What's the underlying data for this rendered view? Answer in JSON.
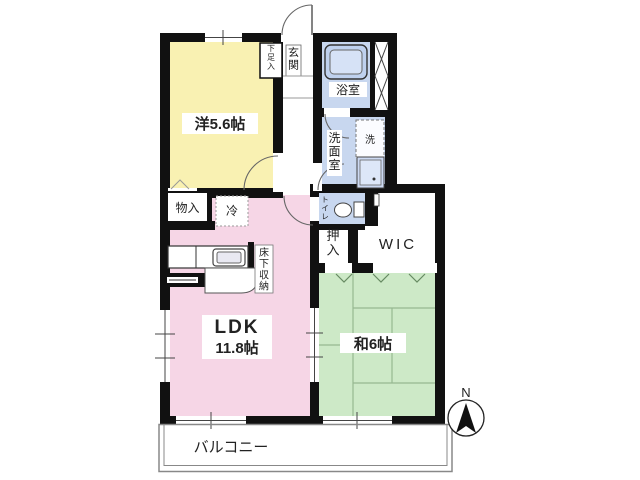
{
  "plan": {
    "type": "apartment-floor-plan",
    "rooms": {
      "western": {
        "label": "洋5.6帖"
      },
      "entrance": {
        "label": "玄関"
      },
      "shoe_cabinet": {
        "label": "下足入"
      },
      "bathroom": {
        "label": "浴室"
      },
      "washroom": {
        "label": "洗面室"
      },
      "washer": {
        "label": "洗"
      },
      "toilet": {
        "label": "トイレ"
      },
      "storage": {
        "label": "物入"
      },
      "fridge": {
        "label": "冷"
      },
      "underfloor_storage": {
        "label": "床下収納"
      },
      "ldk": {
        "label": "LDK",
        "size": "11.8帖"
      },
      "closet": {
        "label": "押入"
      },
      "wic": {
        "label": "WIC"
      },
      "japanese": {
        "label": "和6帖"
      },
      "balcony": {
        "label": "バルコニー"
      }
    },
    "compass": {
      "label": "N"
    },
    "colors": {
      "wall": "#111111",
      "western_room": "#f9f1b2",
      "ldk": "#f6d6e6",
      "japanese_room": "#cde9c7",
      "wet_area": "#c8d7ef",
      "white": "#ffffff"
    }
  }
}
